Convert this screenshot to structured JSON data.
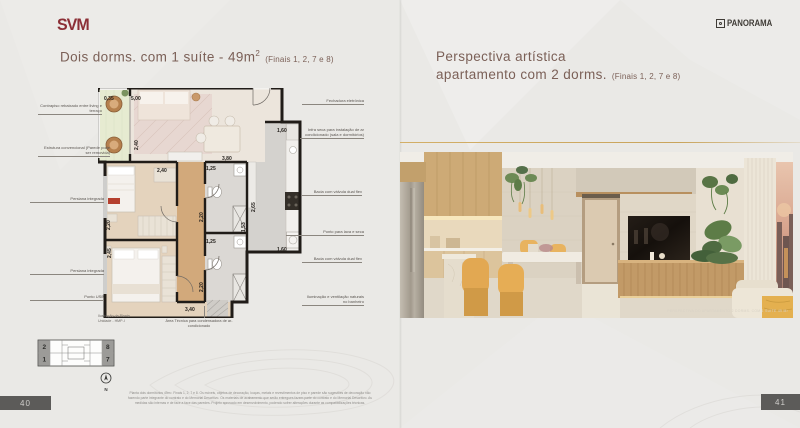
{
  "left_page": {
    "logo": "SVM",
    "title": "Dois dorms. com 1 suíte - 49m",
    "title_sup": "2",
    "title_finais": "(Finais 1, 2, 7 e 8)",
    "plan": {
      "callouts_left": [
        "Contrapiso rebaixado entre living e terraço",
        "Estrutura convencional (Parede pode ser removida)",
        "Persiana integrada",
        "Persiana integrada",
        "Ponto USB"
      ],
      "callouts_right": [
        "Fechadura eletrônica",
        "Infra seca para instalação de ar condicionado (sala e dormitórios)",
        "Bacia com válvula dual flex",
        "Ponto para lava e seca",
        "Bacia com válvula dual flex",
        "Iluminação e ventilação naturais no banheiro"
      ],
      "ac_note": "Área Técnica para condensadora de ar-condicionado",
      "caption_line1": "Ilustração da Planta",
      "caption_line2": "Unidade - HMP-I",
      "dims": [
        "0,35",
        "5,00",
        "2,40",
        "2,40",
        "3,80",
        "1,25",
        "2,20",
        "1,25",
        "2,20",
        "2,20",
        "2,45",
        "3,40",
        "1,60",
        "2,65",
        "1,53",
        "1,60"
      ]
    },
    "keyplan": {
      "units": [
        "2",
        "1",
        "8",
        "7"
      ],
      "compass": "N"
    },
    "disclaimer": "Planta dois dormitórios 49m². Finais 1, 2, 7 e 8. Os móveis, objetos de decoração, louças, metais e revestimentos de piso e parede são sugestões de decoração não fazendo parte integrante do contrato e do Memorial Descritivo. Os materiais de acabamento que serão entregues fazem parte do contrato e do Memorial Descritivo. As medidas são internas e de face a face das paredes. Projeto aprovado em desenvolvimento, podendo sofrer alterações durante as compatibilizações técnicas.",
    "page_number": "40"
  },
  "right_page": {
    "logo": "PANORAMA",
    "title_line1": "Perspectiva artística",
    "title_line2": "apartamento com 2 dorms.",
    "title_finais": "(Finais 1, 2, 7 e 8)",
    "photo_caption": "PERSPECTIVA DO APARTAMENTO 2 DORMS. COM 1 SUÍTE 49 M²",
    "page_number": "41"
  },
  "colors": {
    "accent_gold": "#c9a45c",
    "logo_red": "#8c2f36",
    "title_brown": "#7b6057"
  }
}
